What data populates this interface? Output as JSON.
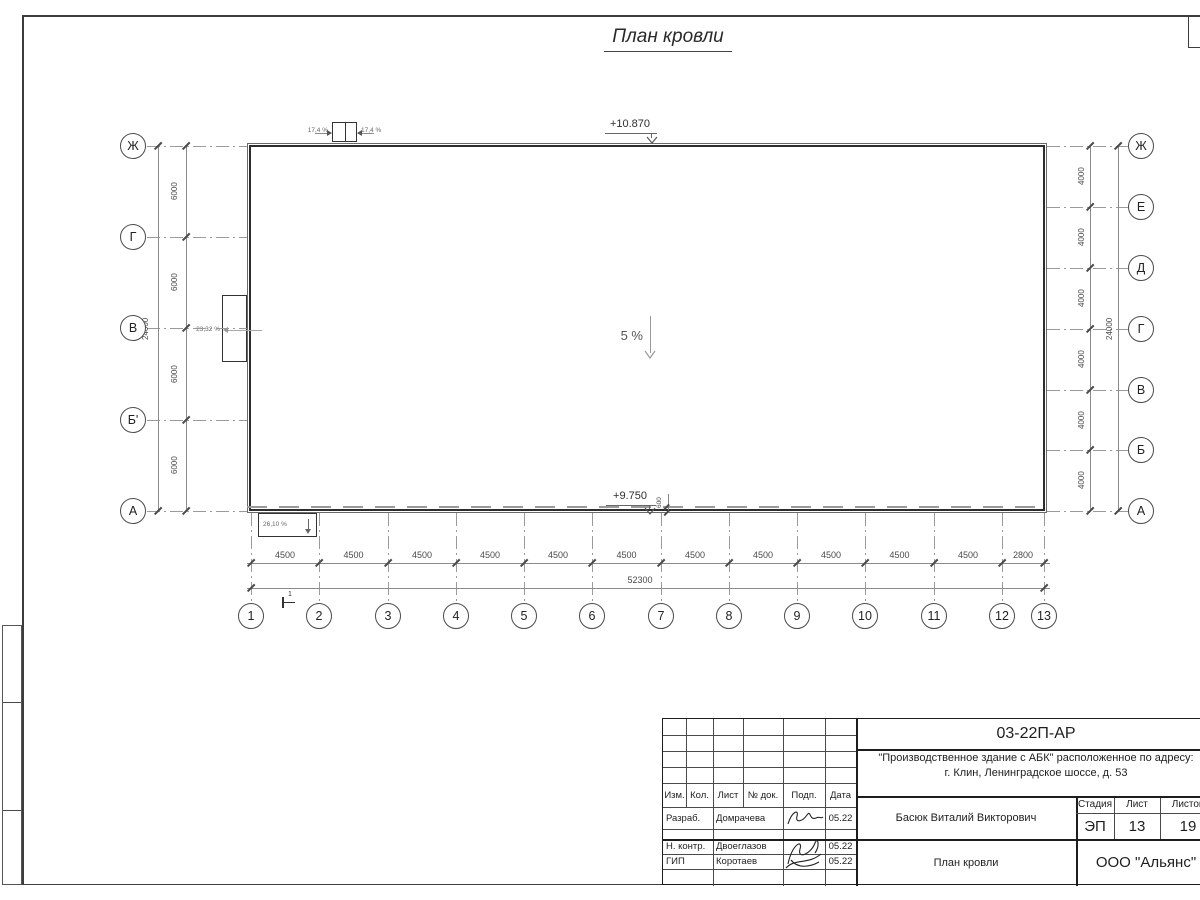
{
  "page": {
    "title": "План кровли"
  },
  "grid": {
    "axes_left": [
      "Ж",
      "Г",
      "В",
      "Б'",
      "А"
    ],
    "axes_right": [
      "Ж",
      "Е",
      "Д",
      "Г",
      "В",
      "Б",
      "А"
    ],
    "columns": [
      "1",
      "2",
      "3",
      "4",
      "5",
      "6",
      "7",
      "8",
      "9",
      "10",
      "11",
      "12",
      "13"
    ],
    "col_spacings": [
      "4500",
      "4500",
      "4500",
      "4500",
      "4500",
      "4500",
      "4500",
      "4500",
      "4500",
      "4500",
      "4500",
      "2800"
    ],
    "total_width": "52300",
    "left_spacings": [
      "6000",
      "6000",
      "6000",
      "6000"
    ],
    "left_total": "24000",
    "right_spacings": [
      "4000",
      "4000",
      "4000",
      "4000",
      "4000",
      "4000"
    ],
    "right_total": "24000"
  },
  "marks": {
    "elevation_top": "+10.870",
    "elevation_bottom": "+9.750",
    "gutter_offset": "600",
    "slope_main": "5 %",
    "slope_hatch_left": "17,4 %",
    "slope_hatch_right": "17,4 %",
    "slope_west_canopy": "23,32 %",
    "slope_south_canopy": "26,10 %",
    "section_mark": "1"
  },
  "titleblock": {
    "doc_number": "03-22П-АР",
    "project_line1": "\"Производственное здание с АБК\" расположенное по адресу:",
    "project_line2": "г. Клин, Ленинградское шоссе, д. 53",
    "header": {
      "izm": "Изм.",
      "kol": "Кол.",
      "list": "Лист",
      "doc": "№ док.",
      "podp": "Подп.",
      "data": "Дата"
    },
    "rows": [
      {
        "role": "Разраб.",
        "name": "Домрачева",
        "date": "05.22"
      },
      {
        "role": "Н. контр.",
        "name": "Двоеглазов",
        "date": "05.22"
      },
      {
        "role": "ГИП",
        "name": "Коротаев",
        "date": "05.22"
      }
    ],
    "chief": "Басюк Виталий Викторович",
    "stage_label": "Стадия",
    "sheet_label": "Лист",
    "sheets_label": "Листов",
    "stage": "ЭП",
    "sheet": "13",
    "sheets": "19",
    "drawing_name": "План кровли",
    "company": "ООО \"Альянс\""
  }
}
